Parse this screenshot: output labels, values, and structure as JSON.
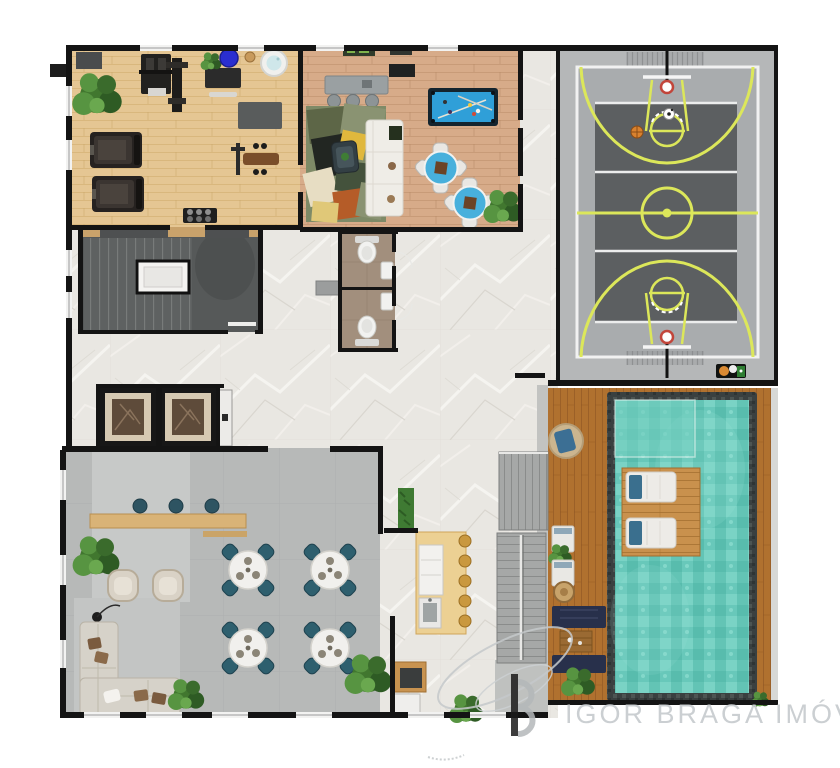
{
  "watermark": {
    "brand": "IGOR BRAGA IMÓVEIS"
  },
  "palette": {
    "wall": "#141414",
    "marble_floor": "#e9e7e2",
    "gym_wood": "#e5c693",
    "lounge_wood": "#d7ab89",
    "party_floor": "#b7b9b8",
    "court_surround": "#b5b7b8",
    "court_surface": "#5c5f61",
    "court_line": "#dcea57",
    "pool_water": "#68c8ba",
    "pool_border": "#3a4040",
    "deck_wood": "#b0712f",
    "platform_wood": "#c9914d",
    "chair_teal": "#2e5f6e",
    "bistro_table_blue": "#48b0dc",
    "billiards_blue": "#2f9fd8",
    "elevator_marble": "#5e4b3a",
    "watermark_gray": "#c9cdd0"
  },
  "areas": [
    {
      "id": "fitness-room",
      "items": [
        "treadmill",
        "treadmill",
        "multi-gym",
        "cable-station",
        "weight-bench",
        "dumbbell-rack",
        "exercise-ball",
        "massage-tub",
        "desk",
        "mat",
        "plants"
      ]
    },
    {
      "id": "games-lounge",
      "items": [
        "billiards-table",
        "sofa",
        "area-rug",
        "armchair",
        "console-table",
        "stools",
        "bistro-table",
        "bistro-table",
        "plant"
      ]
    },
    {
      "id": "sports-court",
      "items": [
        "basketball-hoop",
        "basketball-hoop",
        "center-circle",
        "three-point-arc",
        "three-point-arc",
        "free-throw-circle",
        "free-throw-circle",
        "basketball",
        "soccer-ball",
        "ball-tray",
        "grandstand",
        "grandstand"
      ]
    },
    {
      "id": "stairwell",
      "items": [
        "stair-flight",
        "landing",
        "planters"
      ]
    },
    {
      "id": "restrooms",
      "items": [
        "toilet",
        "toilet",
        "washbasin",
        "washbasin",
        "bench"
      ]
    },
    {
      "id": "elevator-lobby",
      "items": [
        "elevator",
        "elevator",
        "service-door"
      ]
    },
    {
      "id": "party-room",
      "items": [
        "bar-counter",
        "bar-stools",
        "dining-table",
        "dining-table",
        "dining-table",
        "dining-table",
        "armchair",
        "armchair",
        "sectional-sofa",
        "floor-lamp",
        "plants"
      ]
    },
    {
      "id": "buffet-island",
      "items": [
        "counter",
        "cabinet",
        "sink",
        "stools",
        "hedge"
      ]
    },
    {
      "id": "grill-nook",
      "items": [
        "grill-counter",
        "cabinet",
        "plant"
      ]
    },
    {
      "id": "central-stairs",
      "items": [
        "upper-flight",
        "lower-flight",
        "handrail"
      ]
    },
    {
      "id": "pool-terrace",
      "items": [
        "swimming-pool",
        "entry-shelf",
        "in-pool-deck",
        "sun-lounger",
        "sun-lounger",
        "round-daybed",
        "deck-lounger",
        "deck-lounger",
        "wicker-table",
        "lounge-mat",
        "lounge-mat",
        "pallet-table",
        "plants"
      ]
    }
  ]
}
